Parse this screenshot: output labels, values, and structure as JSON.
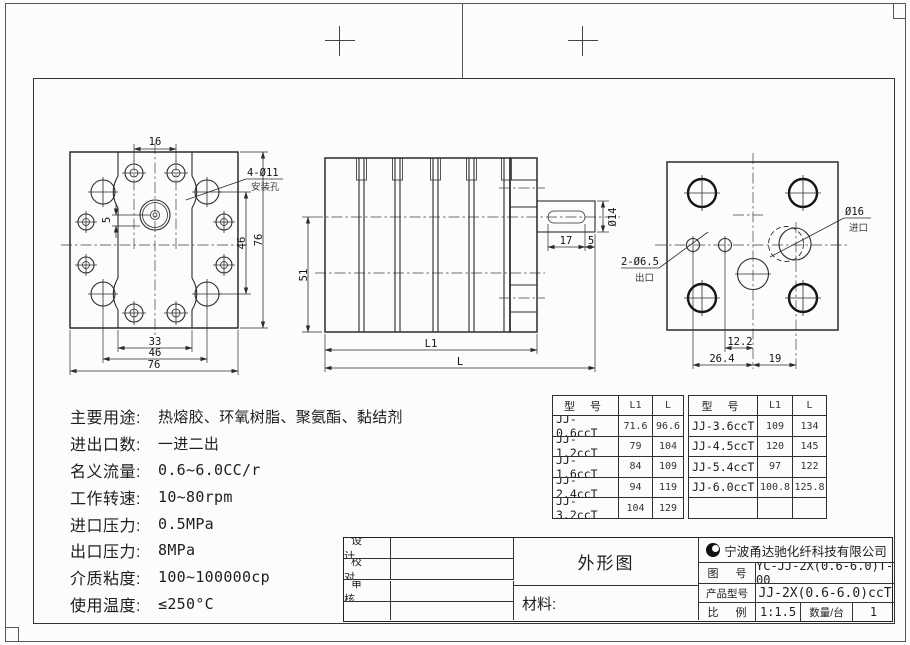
{
  "views": {
    "front": {
      "dim_top_16": "16",
      "dim_offset_5": "5",
      "dim_right_46": "46",
      "dim_right_76": "76",
      "dim_bottom_33": "33",
      "dim_bottom_46": "46",
      "dim_bottom_76": "76",
      "leader_line1": "4-Ø11",
      "leader_line2": "安装孔"
    },
    "side": {
      "dim_height_51": "51",
      "dim_key_17": "17",
      "dim_key_5": "5",
      "dim_shaft_dia": "Ø14",
      "dim_l1": "L1",
      "dim_l": "L"
    },
    "rear": {
      "dim_12_2": "12.2",
      "dim_26_4": "26.4",
      "dim_19": "19",
      "outlet_line1": "2-Ø6.5",
      "outlet_line2": "出口",
      "inlet_line1": "Ø16",
      "inlet_line2": "进口"
    }
  },
  "specs": {
    "lines": [
      {
        "label": "主要用途:",
        "value": "热熔胶、环氧树脂、聚氨酯、黏结剂"
      },
      {
        "label": "进出口数:",
        "value": "一进二出"
      },
      {
        "label": "名义流量:",
        "value": "0.6~6.0CC/r"
      },
      {
        "label": "工作转速:",
        "value": "10~80rpm"
      },
      {
        "label": "进口压力:",
        "value": "0.5MPa"
      },
      {
        "label": "出口压力:",
        "value": "8MPa"
      },
      {
        "label": "介质粘度:",
        "value": "100~100000cp"
      },
      {
        "label": "使用温度:",
        "value": "≤250°C"
      }
    ]
  },
  "model_table": {
    "headers": [
      "型 号",
      "L1",
      "L"
    ],
    "left_rows": [
      [
        "JJ-0.6ccT",
        "71.6",
        "96.6"
      ],
      [
        "JJ-1.2ccT",
        "79",
        "104"
      ],
      [
        "JJ-1.6ccT",
        "84",
        "109"
      ],
      [
        "JJ-2.4ccT",
        "94",
        "119"
      ],
      [
        "JJ-3.2ccT",
        "104",
        "129"
      ]
    ],
    "right_rows": [
      [
        "JJ-3.6ccT",
        "109",
        "134"
      ],
      [
        "JJ-4.5ccT",
        "120",
        "145"
      ],
      [
        "JJ-5.4ccT",
        "97",
        "122"
      ],
      [
        "JJ-6.0ccT",
        "100.8",
        "125.8"
      ],
      [
        "",
        "",
        ""
      ]
    ]
  },
  "title_block": {
    "sign_labels": [
      "设 计",
      "校 对",
      "审 核",
      ""
    ],
    "drawing_name": "外形图",
    "material_label": "材料:",
    "company": "宁波甬达驰化纤科技有限公司",
    "drawing_no_label": "图 号",
    "drawing_no": "YC-JJ-2X(0.6-6.0)T-00",
    "product_model_label": "产品型号",
    "product_model": "JJ-2X(0.6-6.0)ccT",
    "scale_label": "比 例",
    "scale_value": "1:1.5",
    "qty_label": "数量/台",
    "qty_value": "1"
  }
}
